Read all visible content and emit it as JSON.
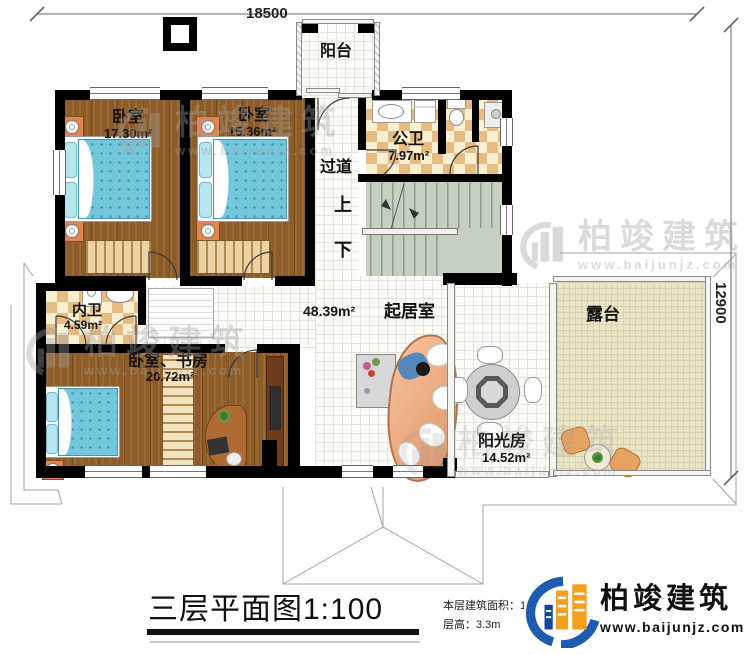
{
  "dimensions": {
    "top": "18500",
    "right": "12900"
  },
  "rooms": {
    "balcony": {
      "name": "阳台"
    },
    "bedroom1": {
      "name": "卧室",
      "area": "17.30m²"
    },
    "bedroom2": {
      "name": "卧室",
      "area": "15.36m²"
    },
    "public_bath": {
      "name": "公卫",
      "area": "7.97m²"
    },
    "corridor": {
      "name": "过道"
    },
    "stairs": {
      "up_label": "上",
      "down_label": "下"
    },
    "inner_bath": {
      "name": "内卫",
      "area": "4.59m²"
    },
    "bedroom_study": {
      "name": "卧室、书房",
      "area": "20.72m²"
    },
    "living_room": {
      "name": "起居室",
      "area": "48.39m²"
    },
    "sunroom": {
      "name": "阳光房",
      "area": "14.52m²"
    },
    "terrace": {
      "name": "露台"
    }
  },
  "title": "三层平面图1:100",
  "footer": {
    "area_label": "本层建筑面积：",
    "area_value": "137.2",
    "floor_height_label": "层高：",
    "floor_height_value": "3.3m"
  },
  "brand": {
    "name": "柏竣建筑",
    "url": "www.baijunjz.com"
  },
  "watermark": {
    "name": "柏竣建筑",
    "url": "www.baijunjz.com"
  },
  "colors": {
    "brand_blue": "#1d5cb0",
    "brand_orange": "#f5a01c",
    "wall_black": "#000000",
    "wood_floor": "#8e5d27",
    "stair_green": "#c5d0c2",
    "terrace_beige": "#ebe4c5",
    "bath_tile_tan": "#e6bc83",
    "bed_blue": "#72c7dd",
    "sofa_peach": "#e8a178"
  }
}
